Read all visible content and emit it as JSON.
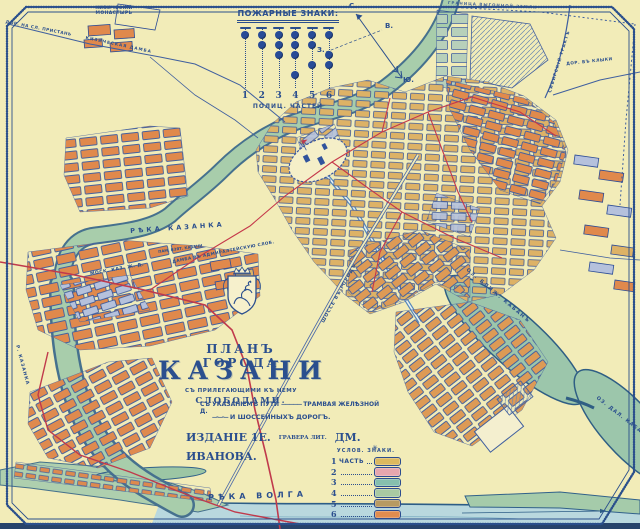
{
  "colors": {
    "paper": "#f2ecb8",
    "ink": "#2b4f8e",
    "red_line": "#c03a4c",
    "river_green": "#a8cdab",
    "water_blue": "#b9d8de",
    "block_orange": "#e0894c",
    "block_tan": "#ddb266",
    "block_blue": "#b5c1dc"
  },
  "fire_signs": {
    "title": "ПОЖАРНЫЕ ЗНАКИ:",
    "subtitle": "ПОЛИЦ. ЧАСТЕЙ",
    "columns": [
      {
        "number": "1",
        "circles": [
          1
        ]
      },
      {
        "number": "2",
        "circles": [
          1,
          1
        ]
      },
      {
        "number": "3",
        "circles": [
          1,
          1,
          1
        ]
      },
      {
        "number": "4",
        "circles": [
          1,
          1,
          1,
          0,
          1
        ]
      },
      {
        "number": "5",
        "circles": [
          1,
          1,
          0,
          1
        ]
      },
      {
        "number": "6",
        "circles": [
          1,
          0,
          1,
          1
        ]
      }
    ]
  },
  "compass": {
    "north": "С.",
    "south": "Ю.",
    "east": "В.",
    "west": "З."
  },
  "title_block": {
    "line1": "ПЛАНЪ ГОРОДА",
    "city": "КАЗАНИ",
    "sub1": "СЪ ПРИЛЕГАЮЩИМИ КЪ НЕМУ",
    "sub2": "СЛОБОДАМИ.",
    "sub3": "СЪ УКАЗАНІЕМЪ ПУТИ",
    "tram_symbol": "—————",
    "tram": "ТРАМВАЯ ЖЕЛѢЗНОЙ Д.",
    "highway_symbol": "—··—··—",
    "sub4": "И ШОССЕЙНЫХЪ ДОРОГЪ.",
    "edition": "ИЗДАНІЕ 1Е.",
    "engraver_small": "ГРАВЕРА ЛИТ.",
    "engraver_name": "ДМ. ИВАНОВА.",
    "ornament": "✳"
  },
  "legend": {
    "title": "УСЛОВ. ЗНАКИ.",
    "rows": [
      {
        "num": "1",
        "label": "ЧАСТЬ",
        "color": "#dcb85f"
      },
      {
        "num": "2",
        "label": "",
        "color": "#e7a7ae"
      },
      {
        "num": "3",
        "label": "",
        "color": "#86bfae"
      },
      {
        "num": "4",
        "label": "",
        "color": "#a9c9a2"
      },
      {
        "num": "5",
        "label": "",
        "color": "#b79a62"
      },
      {
        "num": "6",
        "label": "",
        "color": "#e08c4f"
      }
    ]
  },
  "labels": {
    "kizichesky_monastery": "КИЗИЧЕСКІЙ\nМОНАСТЫРЬ",
    "pier_road": "ДОР. НА СЛ. ПРИСТАНЬ",
    "kizicheskaya_dam": "КИЗИЧЕСКАЯ ДАМБА",
    "kazanka_river": "РѢКА КАЗАНКА",
    "kazanka_river_lower": "Р. КАЗАНКА",
    "monument": "ПАМ. ВЗЯТ. КАЗАНИ",
    "admiralty_dam": "ДАМБА ВЪ АДМИРАЛТЕЙСКУЮ СЛОБ.",
    "railway": "МОСК. КАЗ. Ж. Д.",
    "volga_river": "РѢКА ВОЛГА",
    "near_kaban": "ОЗ. БЛИЖ. КАБАНЪ",
    "far_kaban": "ОЗ. ДАЛ. КАБАНЪ",
    "boundary": "ГРАНИЦА ВЫГОННОЙ ЗЕМЛИ",
    "siberian_highway": "СИБИРСКІЙ ТРАКТЪ",
    "klyki_road": "ДОР. ВЪ КЛЫКИ",
    "city_highway": "ШОССЕ ВЪ ГОРОДЪ"
  }
}
